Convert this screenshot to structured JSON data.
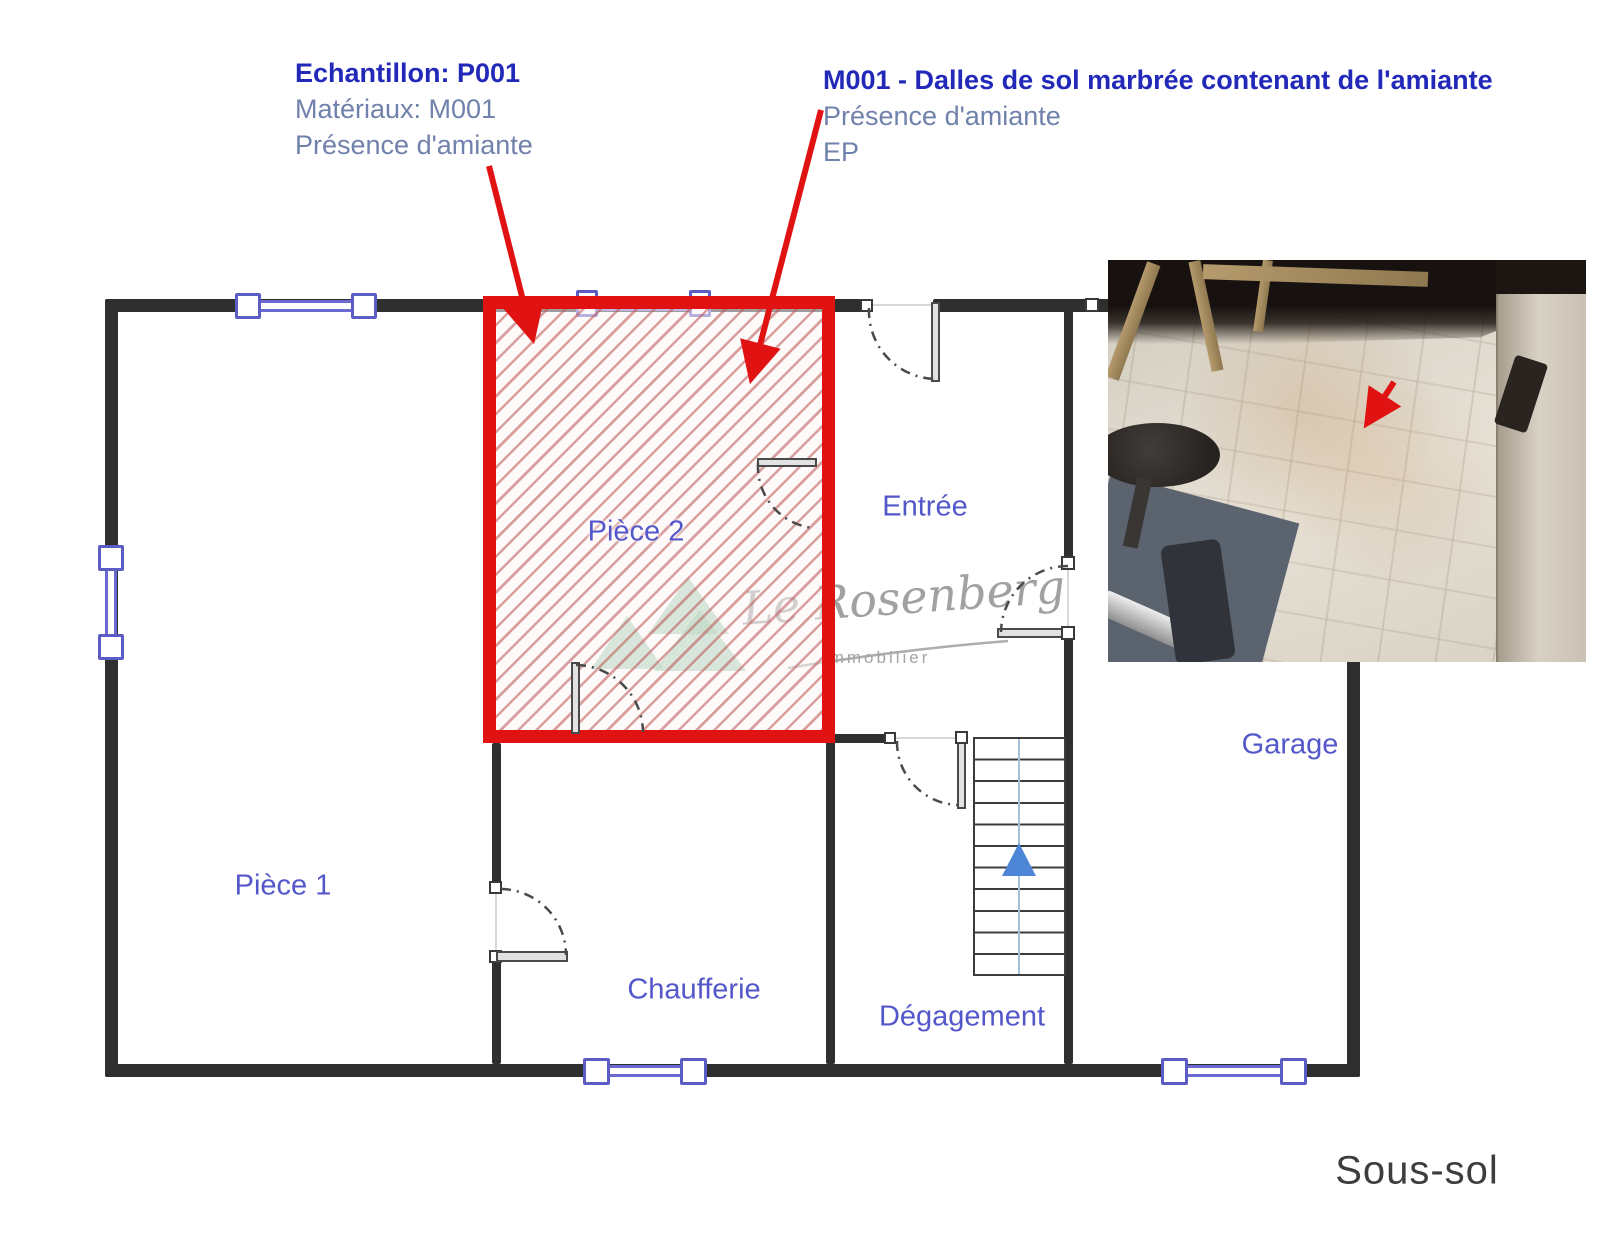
{
  "annotations": {
    "sample": {
      "title": "Echantillon: P001",
      "material_line": "Matériaux: M001",
      "presence_line": "Présence d'amiante"
    },
    "material": {
      "title": "M001 - Dalles de sol marbrée contenant de l'amiante",
      "presence_line": "Présence d'amiante",
      "ep_line": "EP"
    }
  },
  "rooms": {
    "piece1": "Pièce 1",
    "piece2": "Pièce 2",
    "entree": "Entrée",
    "chaufferie": "Chaufferie",
    "degagement": "Dégagement",
    "garage": "Garage"
  },
  "floor_label": "Sous-sol",
  "watermark": {
    "brand": "Le Rosenberg",
    "tagline": "Immobilier"
  },
  "colors": {
    "highlight_red": "#e11212",
    "wall_black": "#2f2f2f",
    "window_blue": "#5c5cc5",
    "room_label_blue": "#5457c9",
    "annotation_title_blue": "#2228b8",
    "annotation_body_blue": "#7081ab",
    "watermark_green": "#6eb288",
    "stairs_arrow_blue": "#4d86d6"
  }
}
